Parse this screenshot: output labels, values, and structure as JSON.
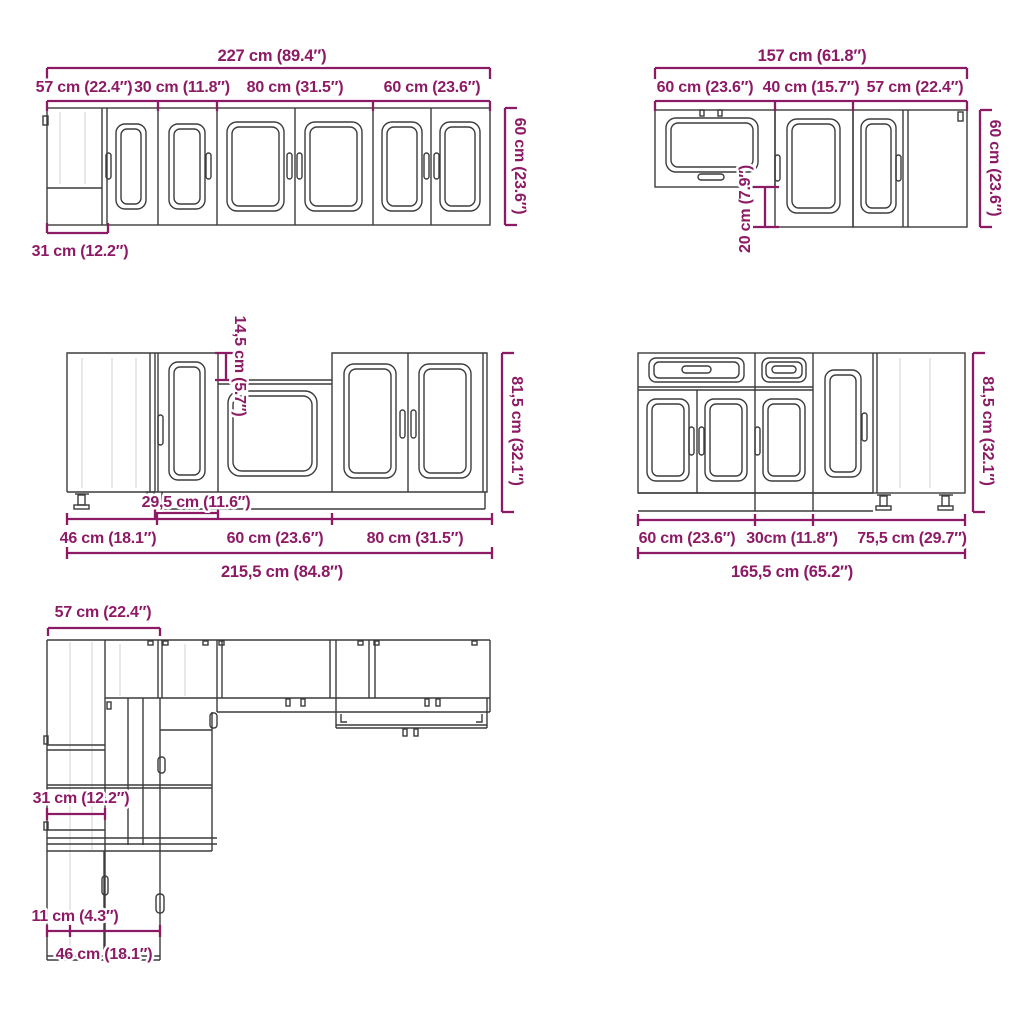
{
  "colors": {
    "dimension": "#8D1A64",
    "line": "#3C3C3B",
    "faint": "#D2D2D0"
  },
  "diagrams": {
    "wall_run_left": {
      "title": "upper wall cabinet run - front view",
      "total": "227 cm (89.4″)",
      "segments": [
        "57 cm (22.4″)",
        "30 cm (11.8″)",
        "80 cm (31.5″)",
        "60 cm (23.6″)"
      ],
      "height": "60 cm (23.6″)",
      "side_depth": "31 cm (12.2″)"
    },
    "wall_run_right": {
      "title": "upper wall cabinet run with bridge unit - front view",
      "total": "157 cm (61.8″)",
      "segments": [
        "60 cm (23.6″)",
        "40 cm (15.7″)",
        "57 cm (22.4″)"
      ],
      "height": "60 cm (23.6″)",
      "gap": "20 cm (7.9″)"
    },
    "base_run_left": {
      "title": "base cabinet run with sink opening - front view",
      "total": "215,5 cm (84.8″)",
      "segments": [
        "46 cm (18.1″)",
        "60 cm (23.6″)",
        "80 cm (31.5″)"
      ],
      "door_width": "29,5 cm (11.6″)",
      "recess": "14,5 cm (5.7″)",
      "height": "81,5 cm (32.1″)"
    },
    "base_run_right": {
      "title": "base cabinet run with drawers - front view",
      "total": "165,5 cm (65.2″)",
      "segments": [
        "60 cm (23.6″)",
        "30cm (11.8″)",
        "75,5 cm (29.7″)"
      ],
      "height": "81,5 cm (32.1″)"
    },
    "plan_view": {
      "title": "L-shaped kitchen - top view",
      "top_width": "57 cm (22.4″)",
      "left_depth": "31 cm (12.2″)",
      "bottom_small": "11 cm (4.3″)",
      "bottom_width": "46 cm (18.1″)"
    }
  }
}
